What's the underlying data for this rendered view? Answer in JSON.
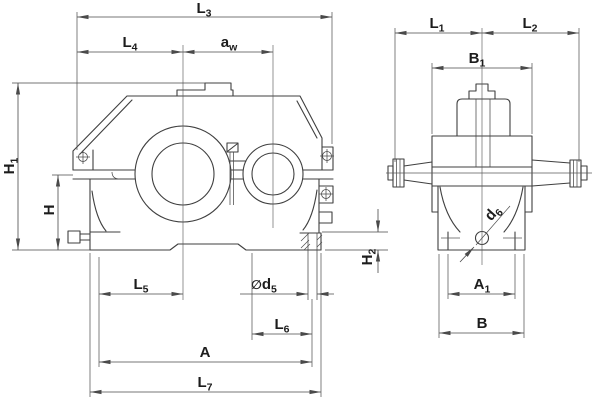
{
  "dims": {
    "L3": {
      "main": "L",
      "sub": "3"
    },
    "L4": {
      "main": "L",
      "sub": "4"
    },
    "aw": {
      "main": "a",
      "sub": "w"
    },
    "H1": {
      "main": "H",
      "sub": "1"
    },
    "H": {
      "main": "H",
      "sub": ""
    },
    "L5": {
      "main": "L",
      "sub": "5"
    },
    "d5": {
      "sym": "∅",
      "main": "d",
      "sub": "5"
    },
    "L6": {
      "main": "L",
      "sub": "6"
    },
    "A": {
      "main": "A",
      "sub": ""
    },
    "L7": {
      "main": "L",
      "sub": "7"
    },
    "H2": {
      "main": "H",
      "sub": "2"
    },
    "L1": {
      "main": "L",
      "sub": "1"
    },
    "L2": {
      "main": "L",
      "sub": "2"
    },
    "B1": {
      "main": "B",
      "sub": "1"
    },
    "A1": {
      "main": "A",
      "sub": "1"
    },
    "B": {
      "main": "B",
      "sub": ""
    },
    "d6": {
      "main": "d",
      "sub": "6"
    }
  },
  "style": {
    "line_color": "#3f3f3f",
    "dim_line_color": "#4a4a4a",
    "label_color": "#1c1c1c",
    "background": "#ffffff"
  }
}
